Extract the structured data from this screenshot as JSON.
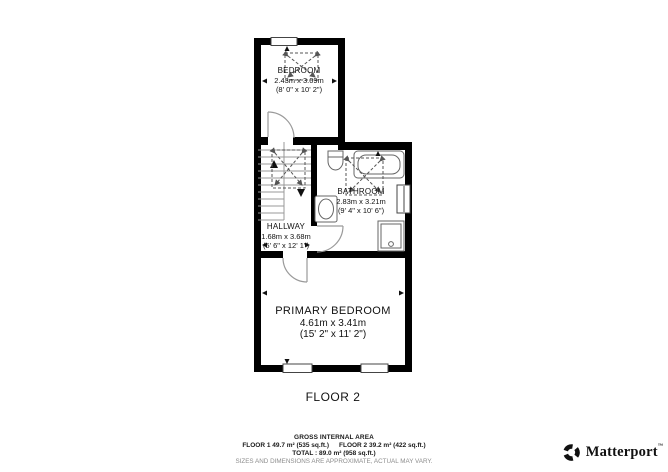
{
  "floor_plan": {
    "floor_label": "FLOOR 2",
    "rooms": [
      {
        "name": "BEDROOM",
        "dim_metric": "2.43m x 3.09m",
        "dim_imperial": "(8' 0\" x 10' 2\")"
      },
      {
        "name": "BATHROOM",
        "dim_metric": "2.83m x 3.21m",
        "dim_imperial": "(9' 4\" x 10' 6\")"
      },
      {
        "name": "HALLWAY",
        "dim_metric": "1.68m x 3.68m",
        "dim_imperial": "(5' 6\" x 12' 1\")"
      },
      {
        "name": "PRIMARY BEDROOM",
        "dim_metric": "4.61m x 3.41m",
        "dim_imperial": "(15' 2\" x 11' 2\")"
      }
    ],
    "fixtures": [
      "toilet",
      "bathtub",
      "sink",
      "shower",
      "stairs"
    ],
    "doors": 3,
    "windows": 4
  },
  "legend": {
    "title": "GROSS INTERNAL AREA",
    "floor1": "FLOOR 1 49.7 m² (535 sq.ft.)",
    "floor2": "FLOOR 2 39.2 m² (422 sq.ft.)",
    "total": "TOTAL :  89.0 m² (958 sq.ft.)",
    "disclaimer": "SIZES AND DIMENSIONS ARE APPROXIMATE, ACTUAL MAY VARY."
  },
  "branding": {
    "logo_text": "Matterport",
    "trademark": "™"
  },
  "colors": {
    "wall": "#000000",
    "fixture": "#666666",
    "door": "#9a9a9a",
    "stairs": "#999999",
    "dashed": "#555555",
    "text": "#1a1a1a",
    "disclaimer_text": "#8d8d8d",
    "background": "#ffffff"
  }
}
